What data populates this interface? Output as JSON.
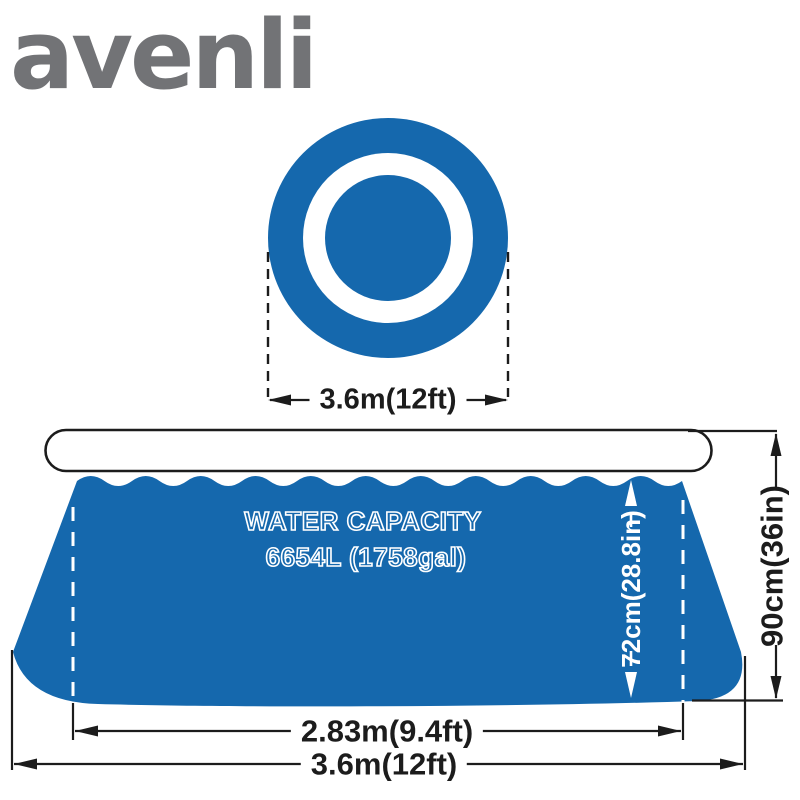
{
  "brand": {
    "logo_text": "avenli"
  },
  "colors": {
    "pool_blue": "#1568ad",
    "line_black": "#1c1c1c",
    "logo_gray": "#727376",
    "background": "#ffffff"
  },
  "top_view": {
    "diameter_label": "3.6m(12ft)"
  },
  "side_view": {
    "capacity_line1": "WATER CAPACITY",
    "capacity_line2": "6654L (1758gal)",
    "water_height_label": "72cm(28.8in)",
    "wall_height_label": "90cm(36in)",
    "base_diameter_label": "2.83m(9.4ft)",
    "bottom_diameter_label": "3.6m(12ft)"
  }
}
